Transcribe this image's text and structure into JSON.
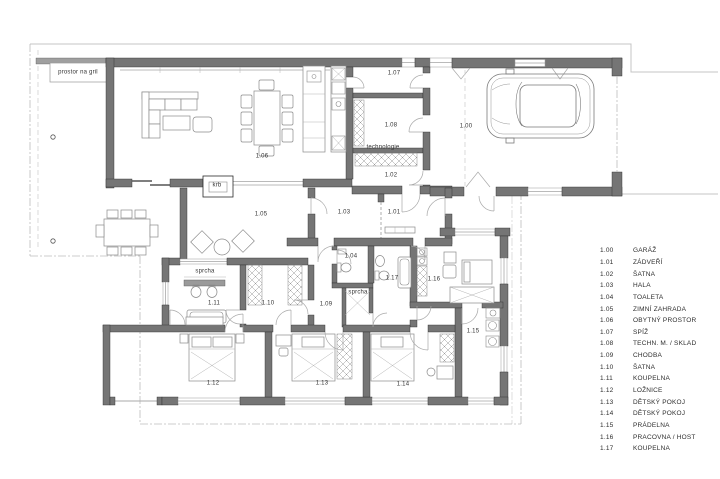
{
  "plan": {
    "labels": [
      {
        "name": "grill-area-label",
        "text": "prostor na gril",
        "x": 78,
        "y": 73
      },
      {
        "name": "fireplace-label",
        "text": "krb",
        "x": 217,
        "y": 186
      },
      {
        "name": "room-number-1-06",
        "text": "1.06",
        "x": 262,
        "y": 157
      },
      {
        "name": "room-number-1-07",
        "text": "1.07",
        "x": 394,
        "y": 74
      },
      {
        "name": "room-number-1-08",
        "text": "1.08",
        "x": 391,
        "y": 126
      },
      {
        "name": "technology-label",
        "text": "technologie",
        "x": 383,
        "y": 148
      },
      {
        "name": "room-number-1-02",
        "text": "1.02",
        "x": 391,
        "y": 176
      },
      {
        "name": "room-number-1-00",
        "text": "1.00",
        "x": 466,
        "y": 127
      },
      {
        "name": "room-number-1-05",
        "text": "1.05",
        "x": 261,
        "y": 215
      },
      {
        "name": "room-number-1-03",
        "text": "1.03",
        "x": 344,
        "y": 213
      },
      {
        "name": "room-number-1-01",
        "text": "1.01",
        "x": 394,
        "y": 213
      },
      {
        "name": "room-number-1-04",
        "text": "1.04",
        "x": 351,
        "y": 257
      },
      {
        "name": "shower-label-1",
        "text": "sprcha",
        "x": 205,
        "y": 272
      },
      {
        "name": "room-number-1-11",
        "text": "1.11",
        "x": 214,
        "y": 304
      },
      {
        "name": "room-number-1-10",
        "text": "1.10",
        "x": 268,
        "y": 304
      },
      {
        "name": "room-number-1-09",
        "text": "1.09",
        "x": 326,
        "y": 305
      },
      {
        "name": "shower-label-2",
        "text": "sprcha",
        "x": 358,
        "y": 293
      },
      {
        "name": "room-number-1-17",
        "text": "1.17",
        "x": 392,
        "y": 279
      },
      {
        "name": "room-number-1-16",
        "text": "1.16",
        "x": 434,
        "y": 280
      },
      {
        "name": "room-number-1-12",
        "text": "1.12",
        "x": 213,
        "y": 384
      },
      {
        "name": "room-number-1-13",
        "text": "1.13",
        "x": 322,
        "y": 384
      },
      {
        "name": "room-number-1-14",
        "text": "1.14",
        "x": 403,
        "y": 385
      },
      {
        "name": "room-number-1-15",
        "text": "1.15",
        "x": 473,
        "y": 332
      }
    ]
  },
  "legend": {
    "rows": [
      {
        "number": "1.00",
        "label": "GARÁŽ"
      },
      {
        "number": "1.01",
        "label": "ZÁDVEŘÍ"
      },
      {
        "number": "1.02",
        "label": "ŠATNA"
      },
      {
        "number": "1.03",
        "label": "HALA"
      },
      {
        "number": "1.04",
        "label": "TOALETA"
      },
      {
        "number": "1.05",
        "label": "ZIMNÍ ZAHRADA"
      },
      {
        "number": "1.06",
        "label": "OBYTNÝ PROSTOR"
      },
      {
        "number": "1.07",
        "label": "SPÍŽ"
      },
      {
        "number": "1.08",
        "label": "TECHN. M. / SKLAD"
      },
      {
        "number": "1.09",
        "label": "CHODBA"
      },
      {
        "number": "1.10",
        "label": "ŠATNA"
      },
      {
        "number": "1.11",
        "label": "KOUPELNA"
      },
      {
        "number": "1.12",
        "label": "LOŽNICE"
      },
      {
        "number": "1.13",
        "label": "DĚTSKÝ POKOJ"
      },
      {
        "number": "1.14",
        "label": "DĚTSKÝ POKOJ"
      },
      {
        "number": "1.15",
        "label": "PRÁDELNA"
      },
      {
        "number": "1.16",
        "label": "PRACOVNA / HOST"
      },
      {
        "number": "1.17",
        "label": "KOUPELNA"
      }
    ]
  },
  "colors": {
    "wall": "#757575",
    "text": "#333333"
  }
}
